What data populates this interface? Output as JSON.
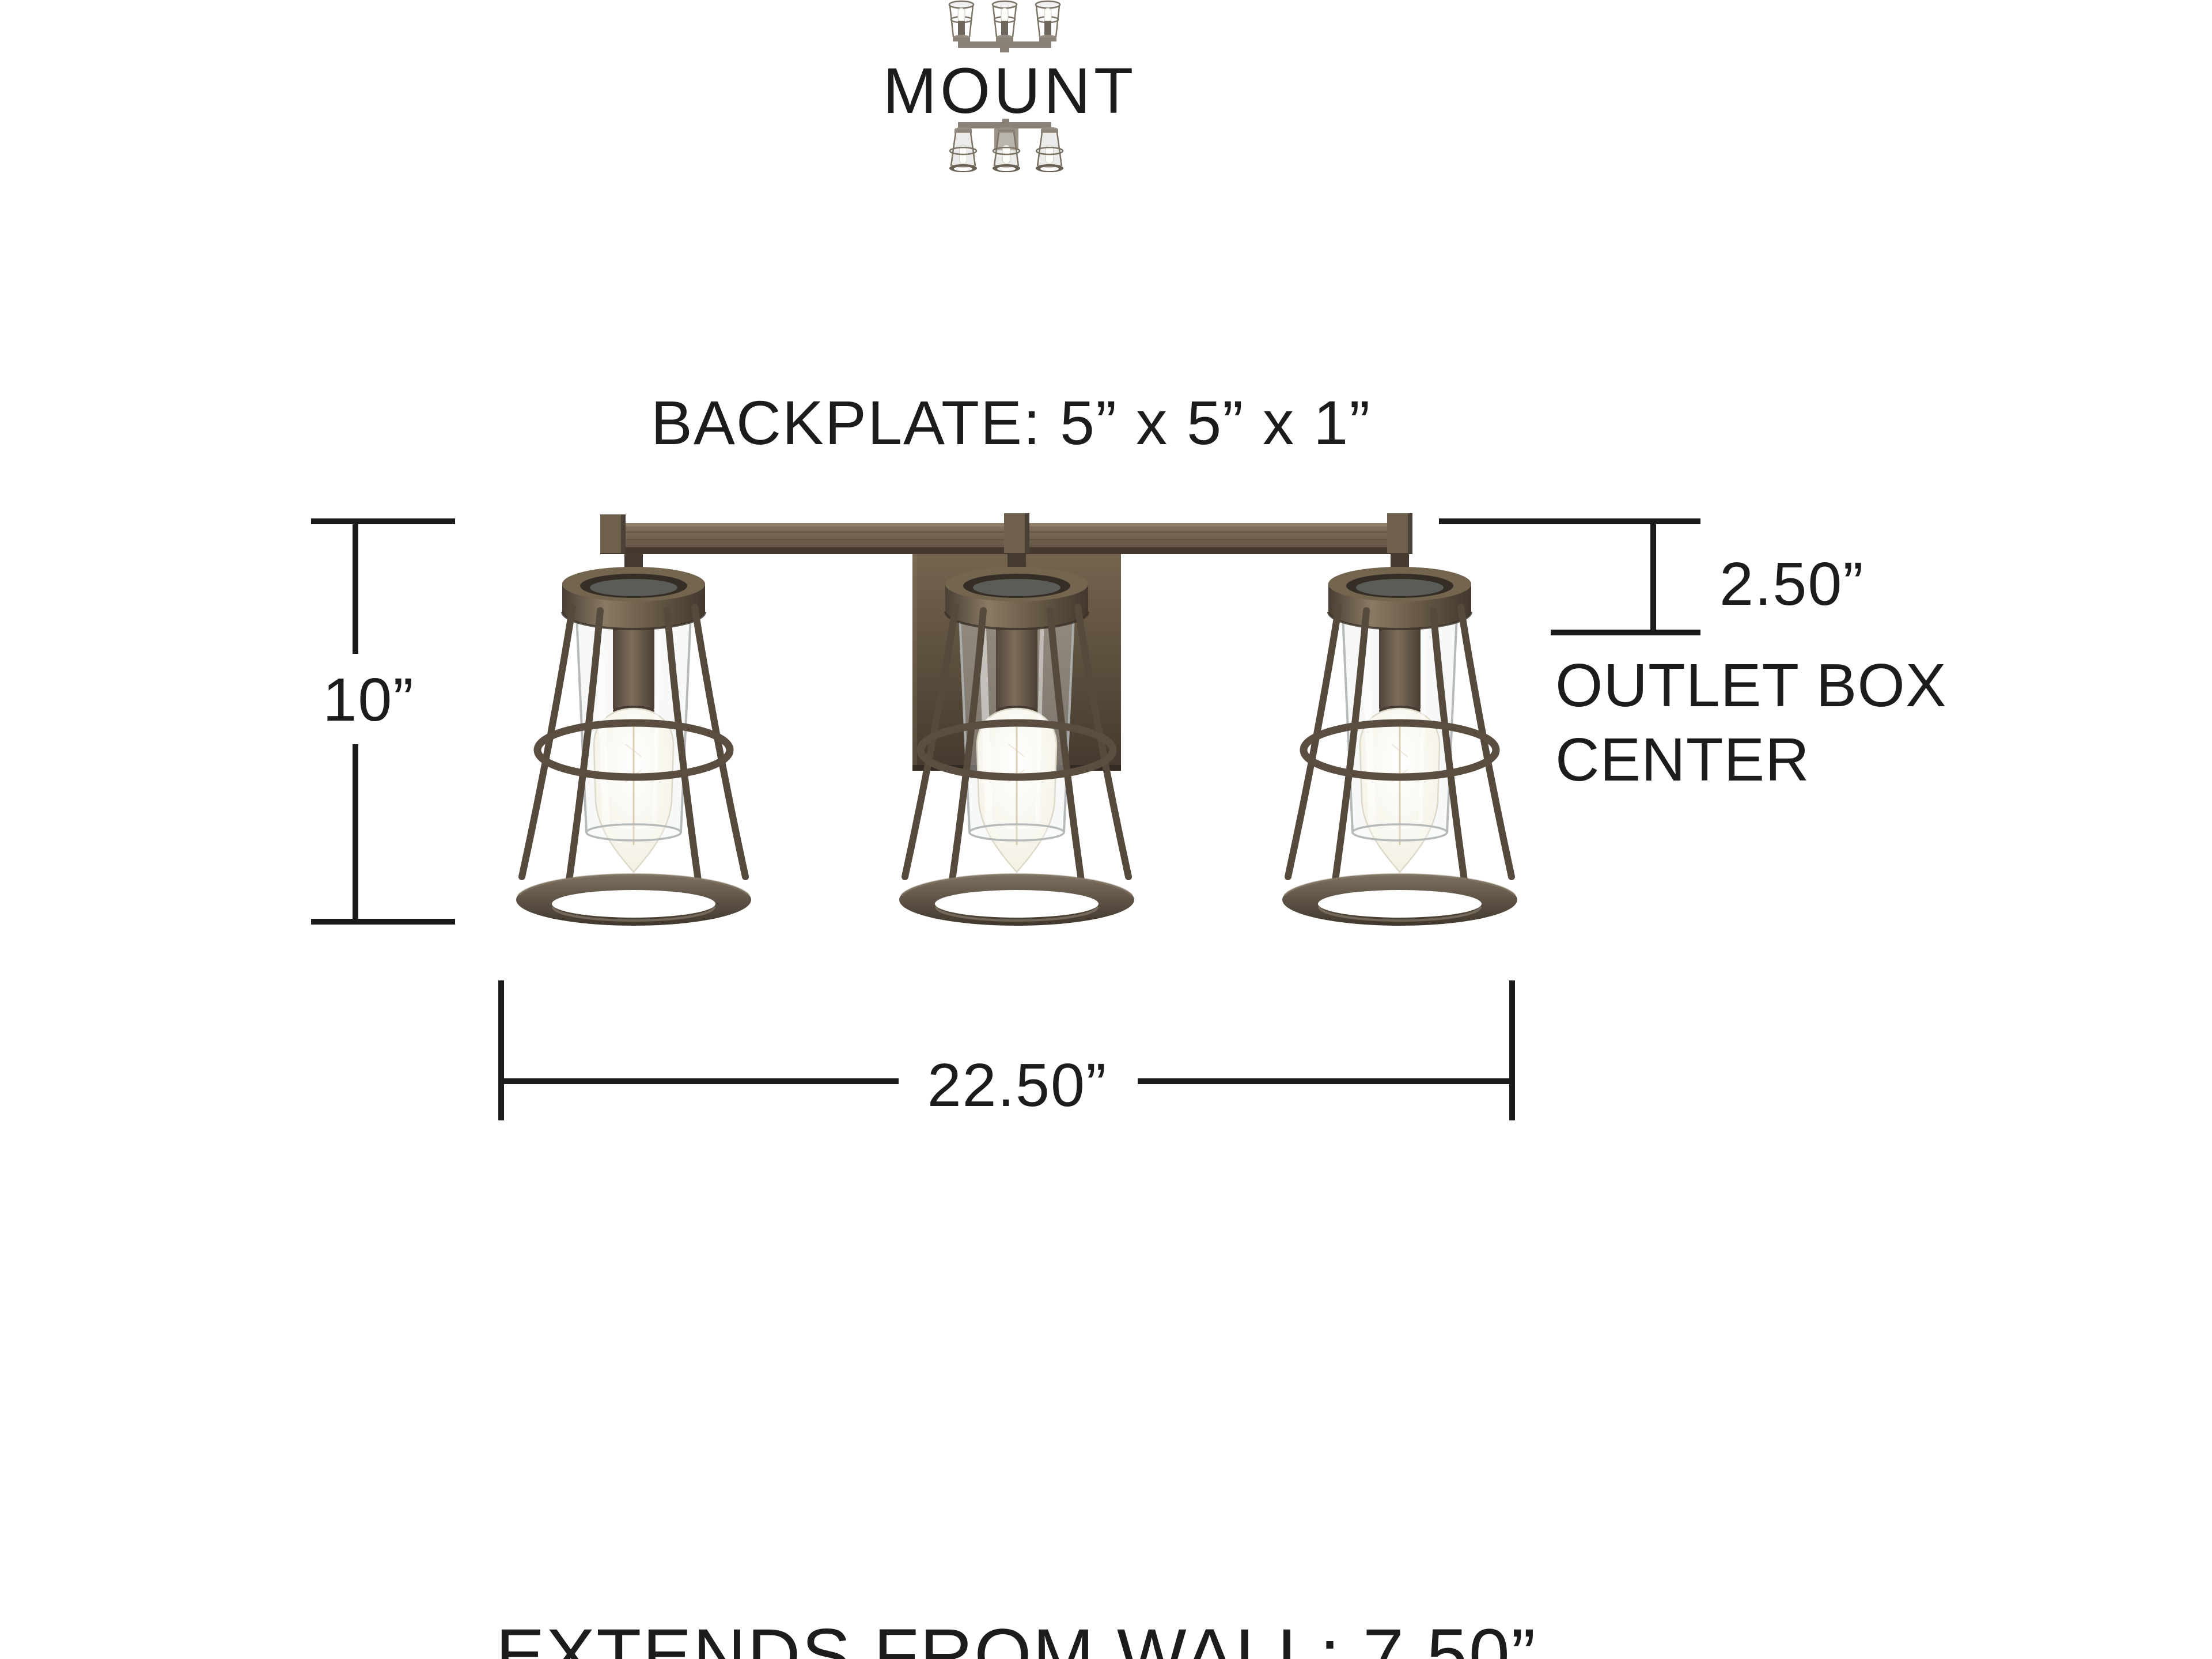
{
  "title": "Vanity light mounting and dimension diagram",
  "colors": {
    "background": "#ffffff",
    "line": "#1b1b1b",
    "text": "#1c1c1c",
    "wood_light": "#84735f",
    "wood_mid": "#6b5c49",
    "wood_dark": "#44392d",
    "metal": "#564a3d",
    "glass_edge": "#aeb3b2",
    "bulb_glow": "#fbfaf4",
    "filament": "#cfc09c",
    "thumb_metal": "#8a8276"
  },
  "header": {
    "mount_label": "MOUNT",
    "top_thumbnail_icon": "vanity-light-mounted-up-thumbnail",
    "bottom_thumbnail_icon": "vanity-light-mounted-down-thumbnail"
  },
  "backplate": {
    "label": "BACKPLATE: 5” x 5” x 1”"
  },
  "fixture": {
    "name": "3-light cage vanity fixture",
    "light_count": 3
  },
  "dimensions": {
    "height_label": "10”",
    "outlet_offset_label": "2.50”",
    "outlet_box_line1": "OUTLET BOX",
    "outlet_box_line2": "CENTER",
    "width_label": "22.50”",
    "extends_label": "EXTENDS FROM WALL: 7.50”"
  }
}
